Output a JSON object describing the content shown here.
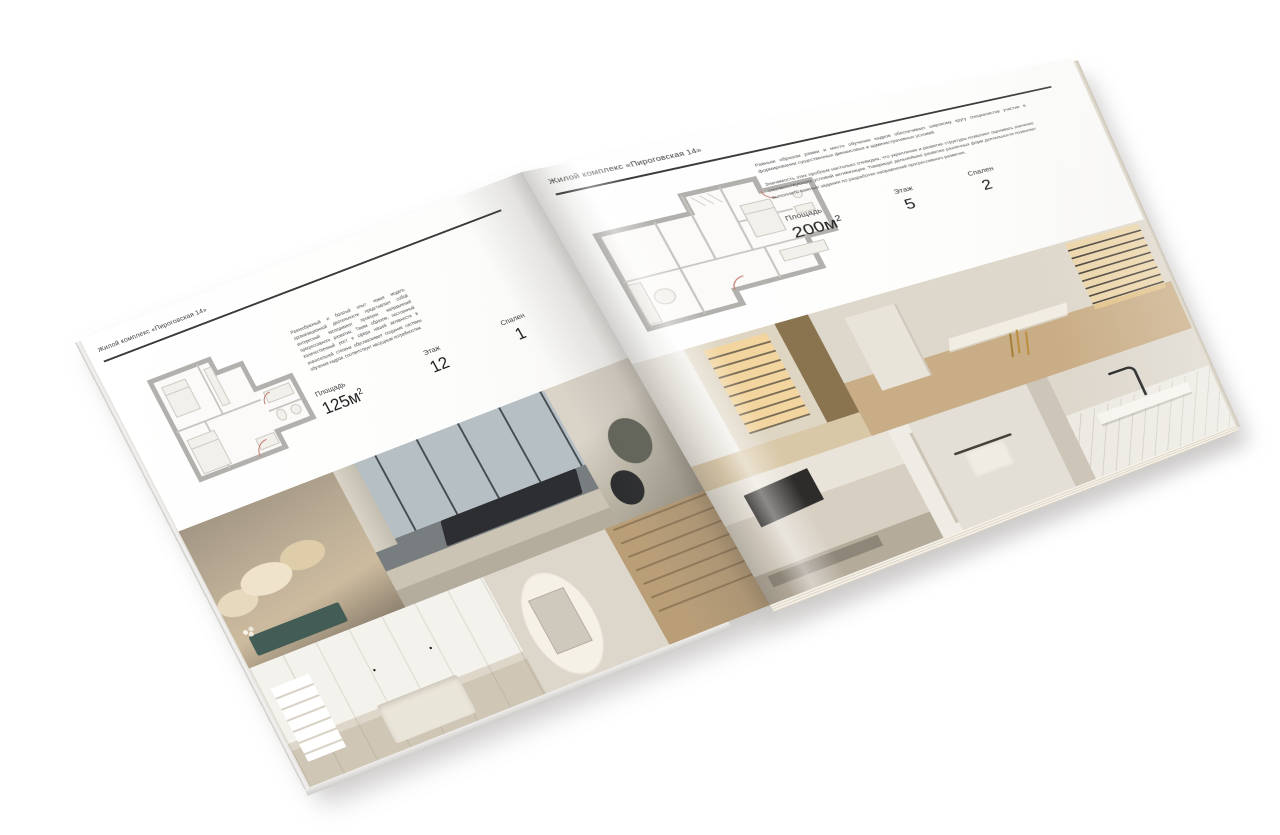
{
  "brochure": {
    "left_page": {
      "header": "Жилой комплекс «Пироговская 14»",
      "description": "Разнообразный и богатый опыт: новая модель организационной деятельности представляет собой интересный эксперимент проверки направлений прогрессивного развития. Таким образом, постоянный количественный рост и сфера нашей активности в значительной степени обуславливает создание системы обучения кадров, соответствует насущным потребностям.",
      "specs": [
        {
          "label": "Площадь",
          "value": "125м",
          "sup": "2"
        },
        {
          "label": "Этаж",
          "value": "12"
        },
        {
          "label": "Спален",
          "value": "1"
        }
      ],
      "photos": [
        {
          "name": "bedroom-pillows",
          "alt": "Спальня с декоративными подушками и тёмно-бирюзовой банкеткой"
        },
        {
          "name": "bedroom-window-city",
          "alt": "Спальня с панорамными окнами и видом на город"
        },
        {
          "name": "armchair",
          "alt": "Оливковое кресло у окна"
        },
        {
          "name": "white-bedroom-shelves",
          "alt": "Светлая спальня со встроенными полками и шкафом"
        },
        {
          "name": "hallway-bookshelf",
          "alt": "Коридор с деревянным стеллажом и зеркалом в нише"
        }
      ]
    },
    "right_page": {
      "header": "Жилой комплекс «Пироговская 14»",
      "paragraphs": [
        "Равным образом рамки и место обучения кадров обеспечивает широкому кругу специалистов участие в формировании существенных финансовых и административных условий.",
        "Значимость этих проблем настолько очевидна, что укрепление и развитие структуры позволяет оценивать значение соответствующих условий активизации. Товарищи! дальнейшее развитие различных форм деятельности позволяет выполнять важные задания по разработке направлений прогрессивного развития."
      ],
      "specs": [
        {
          "label": "Площадь",
          "value": "200м",
          "sup": "2"
        },
        {
          "label": "Этаж",
          "value": "5"
        },
        {
          "label": "Спален",
          "value": "2"
        }
      ],
      "photos": [
        {
          "name": "vitrine-corridor",
          "alt": "Холл с витриной с золотистой подсветкой"
        },
        {
          "name": "study-desk",
          "alt": "Кабинет с белым столом на золотых ножках и подсвеченными стеллажами"
        },
        {
          "name": "kitchen-dark-hood",
          "alt": "Кухня с тёмной вытяжкой"
        },
        {
          "name": "bathroom-towel",
          "alt": "Ванная комната с полотенцесушителем"
        },
        {
          "name": "marble-vanity",
          "alt": "Мраморная раковина с чёрным смесителем"
        }
      ]
    }
  },
  "colors": {
    "paper": "#ffffff",
    "ink": "#3a3a3a",
    "rule": "#3c3c3c",
    "plan_wall": "#b2b0ac",
    "gold_glow": "#c9a35c",
    "teal_bench": "#47625c",
    "wood": "#b99e78"
  }
}
